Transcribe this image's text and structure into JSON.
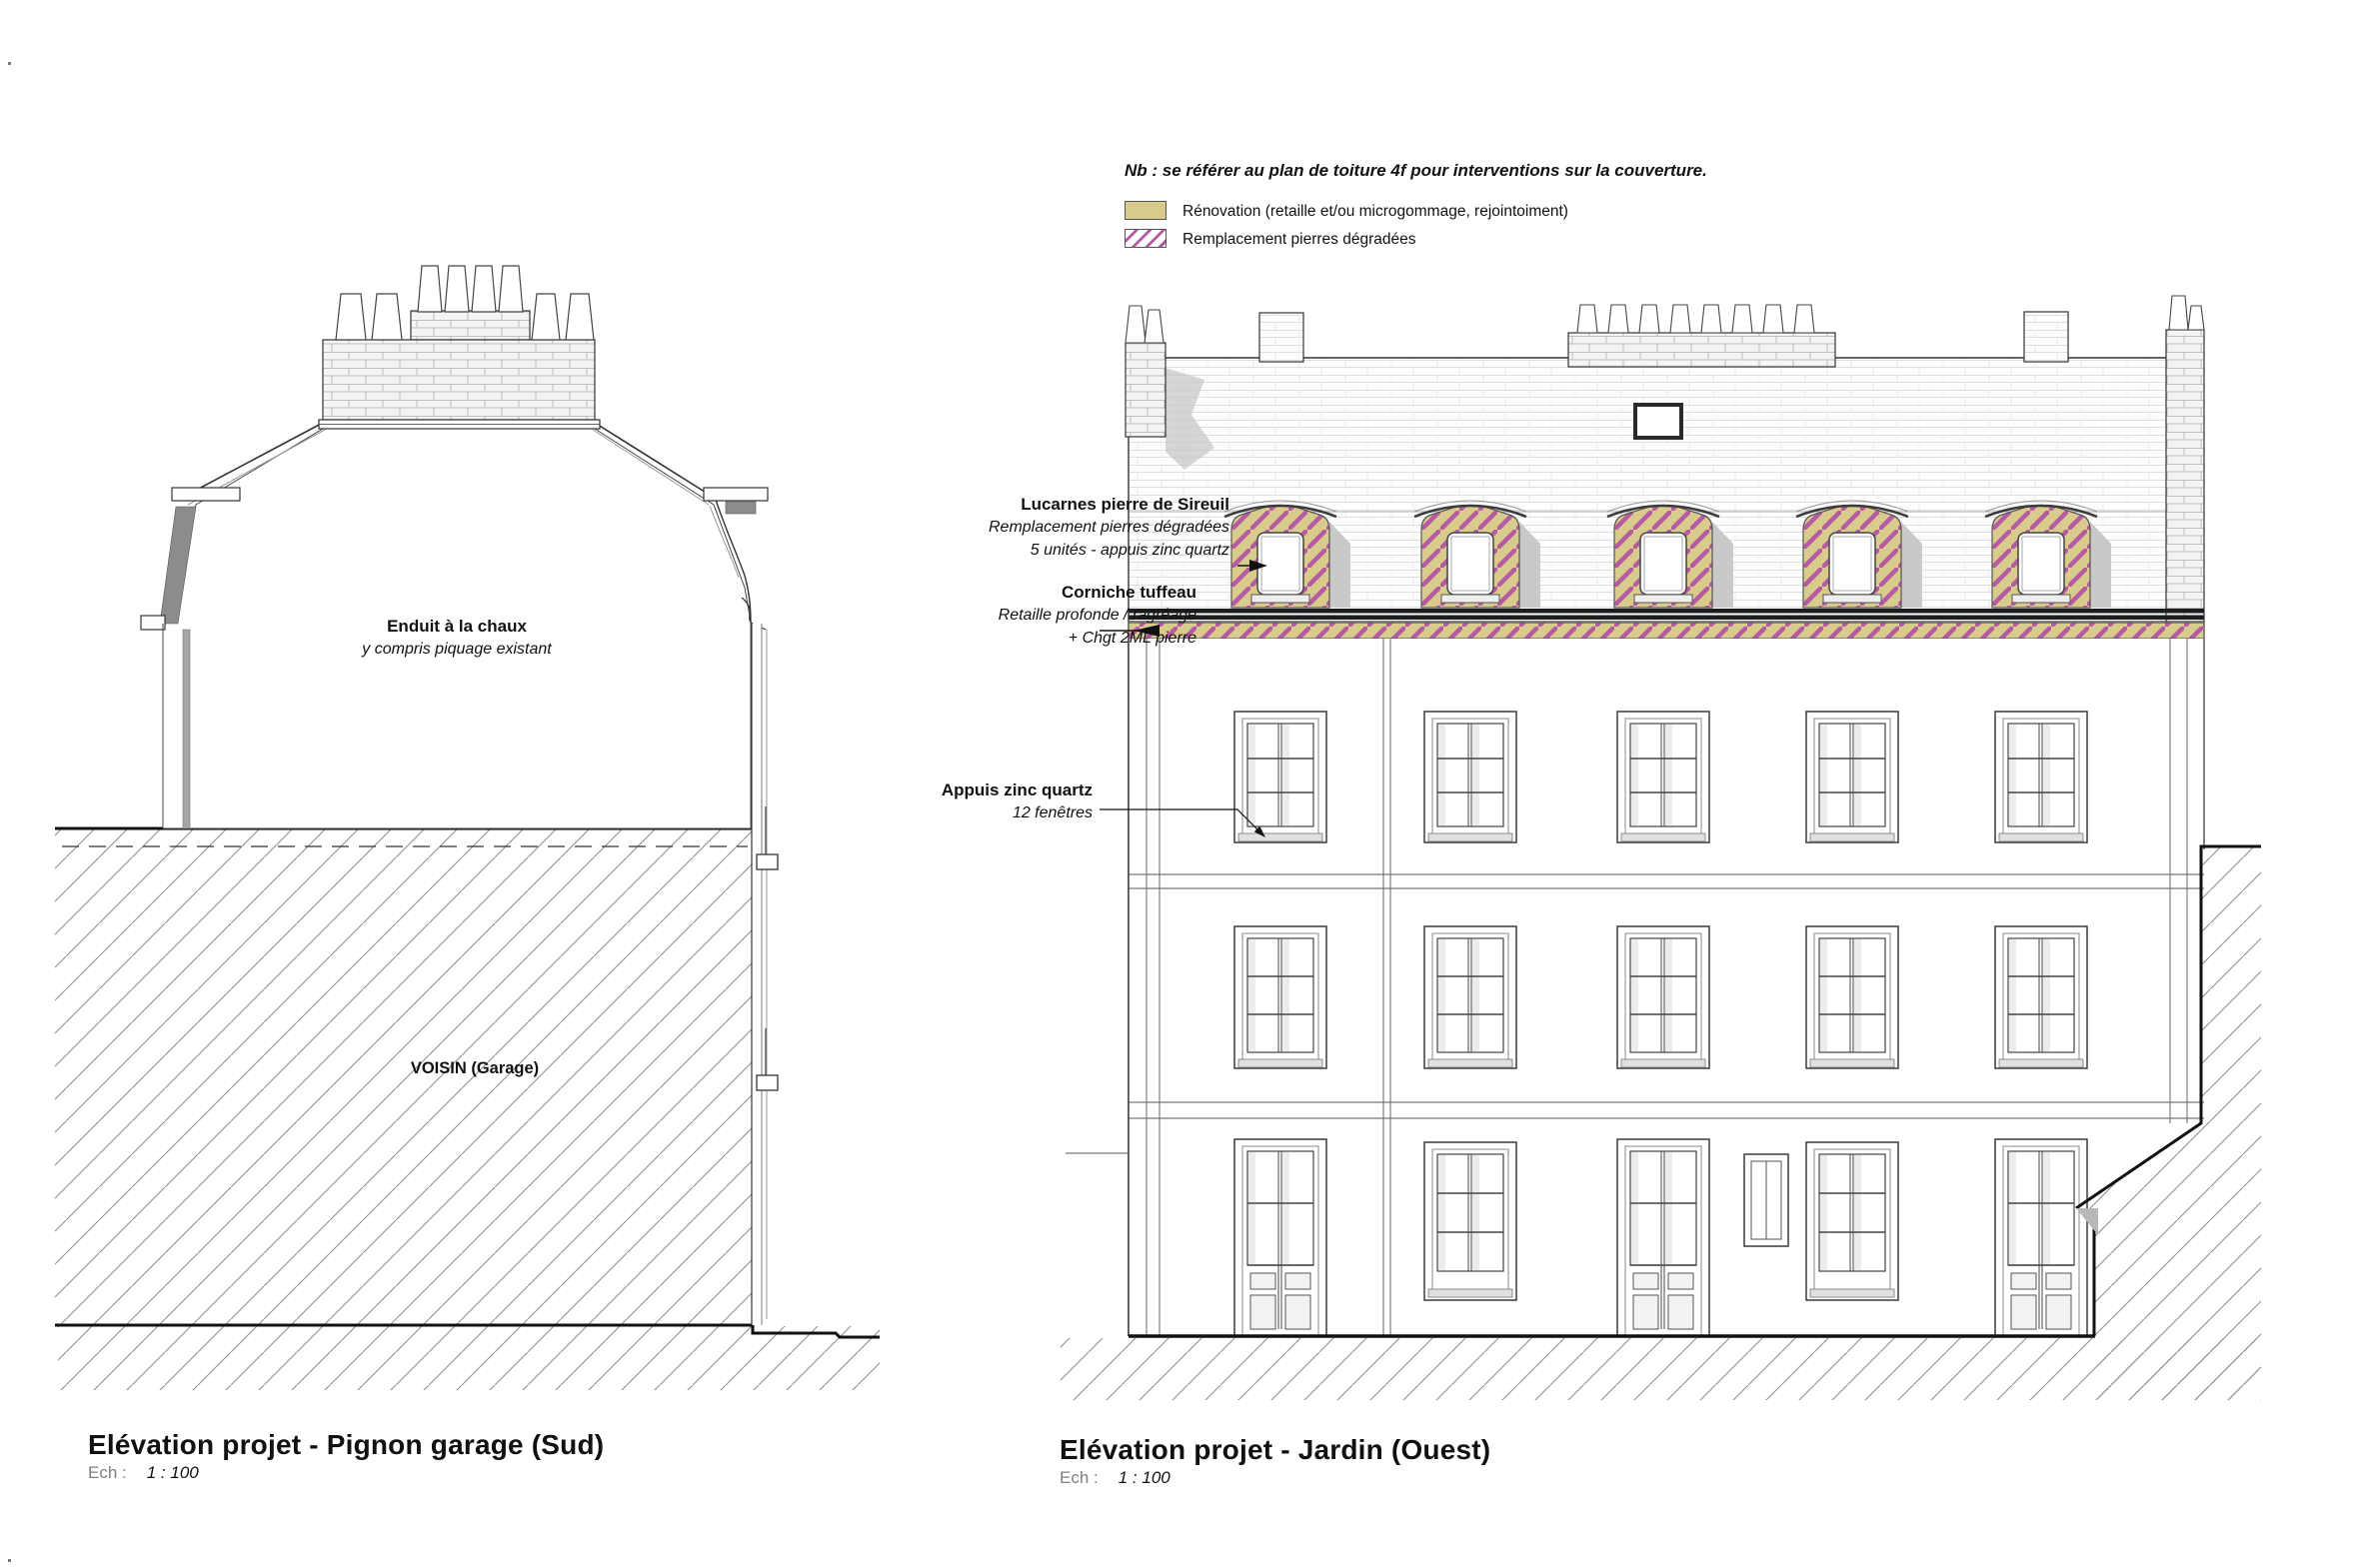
{
  "legend": {
    "note": "Nb : se référer au plan de toiture 4f pour  interventions sur la couverture.",
    "items": [
      {
        "id": "renovation",
        "label": "Rénovation (retaille et/ou microgommage, rejointoiment)",
        "swatch": "solid-tan"
      },
      {
        "id": "remplacement",
        "label": "Remplacement pierres dégradées",
        "swatch": "pink-hatch"
      }
    ]
  },
  "colors": {
    "renovation_tan": "#d9cb8b",
    "stripe_magenta": "#b75aa4",
    "line_dark": "#1c1c1c",
    "shadow_gray": "#c9c9c9"
  },
  "left_view": {
    "wall_note_title": "Enduit à la chaux",
    "wall_note_sub": "y compris piquage existant",
    "neighbor_label": "VOISIN (Garage)",
    "title": "Elévation projet - Pignon garage (Sud)",
    "scale_label": "Ech :",
    "scale_value": "1 : 100"
  },
  "right_view": {
    "ann_lucarnes": {
      "title": "Lucarnes pierre de Sireuil",
      "line2": "Remplacement pierres dégradées",
      "line3": "5 unités - appuis zinc quartz"
    },
    "ann_corniche": {
      "title": "Corniche tuffeau",
      "line2": "Retaille profonde / ragréage",
      "line3": "+ Chgt 2ML pierre"
    },
    "ann_appuis": {
      "title": "Appuis zinc quartz",
      "line2": "12 fenêtres"
    },
    "title": "Elévation projet - Jardin (Ouest)",
    "scale_label": "Ech :",
    "scale_value": "1 : 100"
  }
}
